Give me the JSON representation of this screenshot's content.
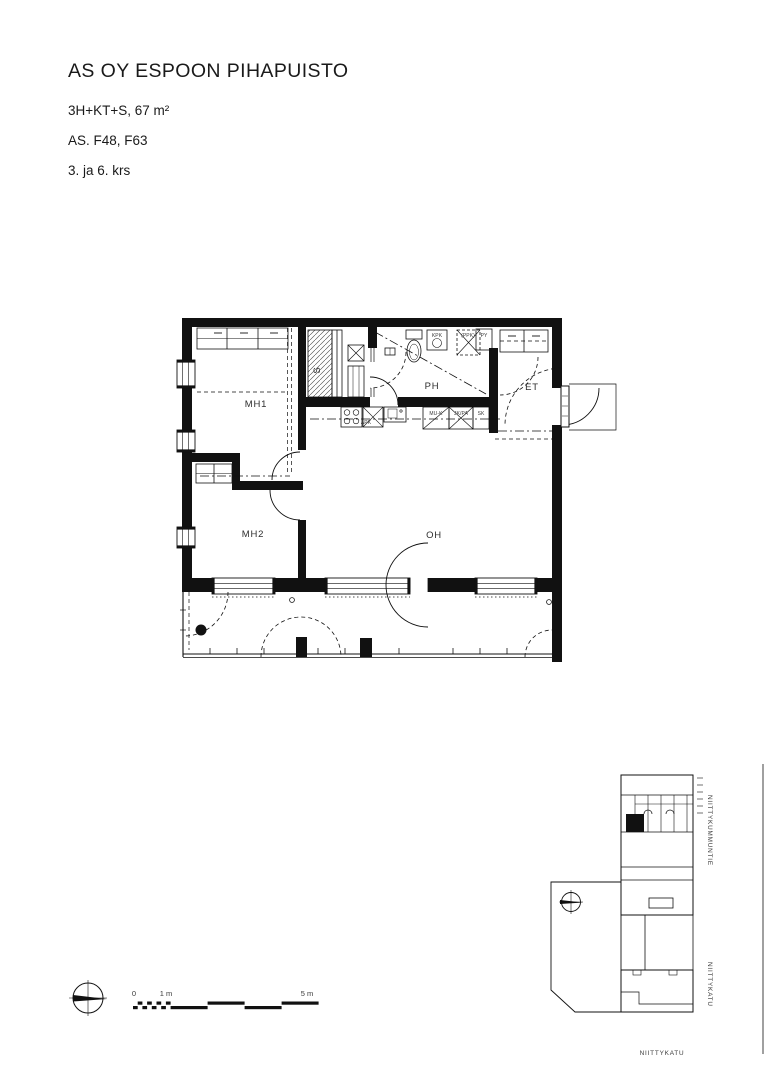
{
  "header": {
    "title": "AS OY ESPOON PIHAPUISTO",
    "apartment_type": "3H+KT+S, 67 m²",
    "apartment_numbers": "AS. F48, F63",
    "floors": "3. ja 6. krs"
  },
  "floor_plan": {
    "rooms": {
      "mh1": "MH1",
      "mh2": "MH2",
      "oh": "OH",
      "ph": "PH",
      "sauna": "S",
      "et": "ET"
    },
    "fixtures": {
      "kpk": "KPK",
      "ppk_reservation": "(PPK)",
      "py": "PY",
      "apk": "APK",
      "mu_k": "MU-K",
      "jk_pa": "JK/PA",
      "sk": "SK"
    }
  },
  "site_plan": {
    "street_right_top": "NIITTYKUMMUNTIE",
    "street_right_bottom": "NIITTYKATU",
    "street_bottom": "NIITTYKATU"
  },
  "scale_bar": {
    "zero": "0",
    "one_m": "1 m",
    "five_m": "5 m"
  },
  "colors": {
    "line": "#111111",
    "background": "#ffffff"
  }
}
